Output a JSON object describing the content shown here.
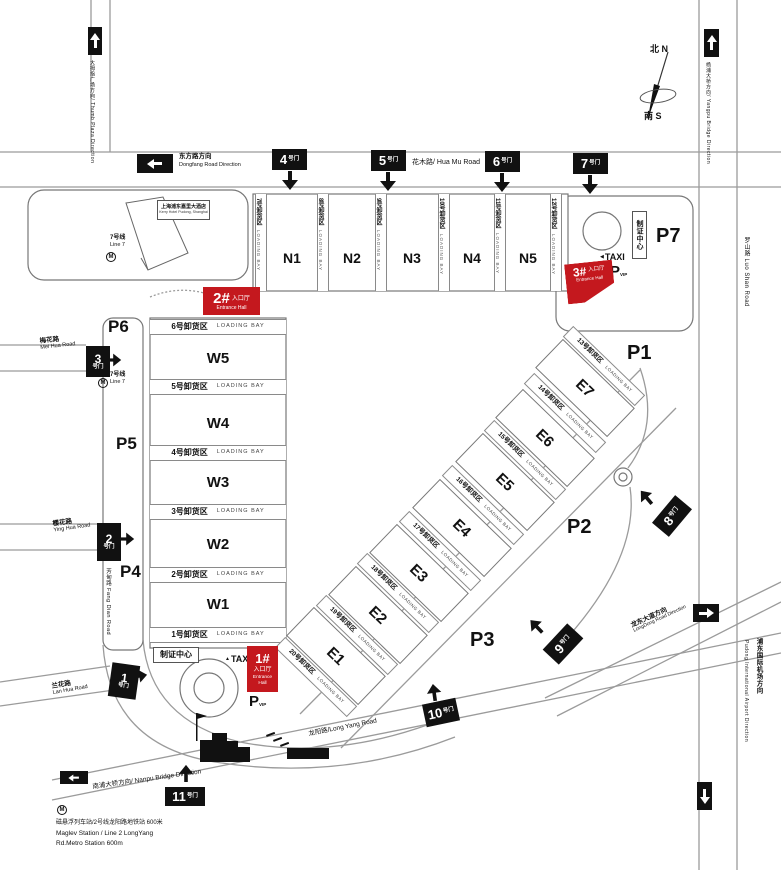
{
  "colors": {
    "accent_red": "#c4181e",
    "gate_black": "#111111",
    "line_gray": "#9b9b9b"
  },
  "compass": {
    "north": "北 N",
    "south": "南 S"
  },
  "directions": {
    "thumb_plaza": "大拇指广场方向/ Thumb Plaza Direction",
    "dongfang_zh": "东方路方向",
    "dongfang_en": "Dongfang Road Direction",
    "yangpu": "杨浦大桥方向/ Yangpu Bridge Direction",
    "longdong_zh": "龙东大道方向",
    "longdong_en": "LongDong Road Direction",
    "airport_zh": "浦东国际机场方向",
    "airport_en": "Pudong International Airport Direction",
    "nanpu": "南浦大桥方向/ Nanpu Bridge Direction"
  },
  "roads": {
    "huamu": "花木路/ Hua Mu Road",
    "meihua_zh": "梅花路",
    "meihua_en": "Mei Hua Road",
    "yinghua_zh": "樱花路",
    "yinghua_en": "Ying Hua Road",
    "lanhua_zh": "兰花路",
    "lanhua_en": "Lan Hua Road",
    "fangdian": "芳甸路 Fang Dian Road",
    "luoshan": "罗山路 Luo Shan Road",
    "longyang": "龙阳路/Long Yang Road"
  },
  "gates": [
    "1",
    "2",
    "3",
    "4",
    "5",
    "6",
    "7",
    "8",
    "9",
    "10",
    "11"
  ],
  "gate_suffix": "号门",
  "halls_north": [
    "N1",
    "N2",
    "N3",
    "N4",
    "N5"
  ],
  "halls_west": [
    "W5",
    "W4",
    "W3",
    "W2",
    "W1"
  ],
  "halls_east": [
    "E1",
    "E2",
    "E3",
    "E4",
    "E5",
    "E6",
    "E7"
  ],
  "bays_north": [
    {
      "zh": "7号卸货区",
      "en": "LOADING BAY"
    },
    {
      "zh": "8号卸货区",
      "en": "LOADING BAY"
    },
    {
      "zh": "9号卸货区",
      "en": "LOADING BAY"
    },
    {
      "zh": "10号卸货区",
      "en": "LOADING BAY"
    },
    {
      "zh": "11号卸货区",
      "en": "LOADING BAY"
    },
    {
      "zh": "12号卸货区",
      "en": "LOADING BAY"
    }
  ],
  "bays_west": [
    {
      "zh": "6号卸货区",
      "en": "LOADING BAY"
    },
    {
      "zh": "5号卸货区",
      "en": "LOADING BAY"
    },
    {
      "zh": "4号卸货区",
      "en": "LOADING BAY"
    },
    {
      "zh": "3号卸货区",
      "en": "LOADING BAY"
    },
    {
      "zh": "2号卸货区",
      "en": "LOADING BAY"
    },
    {
      "zh": "1号卸货区",
      "en": "LOADING BAY"
    }
  ],
  "bays_east": [
    {
      "zh": "20号卸货区",
      "en": "LOADING BAY"
    },
    {
      "zh": "19号卸货区",
      "en": "LOADING BAY"
    },
    {
      "zh": "18号卸货区",
      "en": "LOADING BAY"
    },
    {
      "zh": "17号卸货区",
      "en": "LOADING BAY"
    },
    {
      "zh": "16号卸货区",
      "en": "LOADING BAY"
    },
    {
      "zh": "15号卸货区",
      "en": "LOADING BAY"
    },
    {
      "zh": "14号卸货区",
      "en": "LOADING BAY"
    },
    {
      "zh": "13号卸货区",
      "en": "LOADING BAY"
    }
  ],
  "parking": [
    "P1",
    "P2",
    "P3",
    "P4",
    "P5",
    "P6",
    "P7"
  ],
  "entrances": [
    {
      "num": "1#",
      "zh": "入口厅",
      "en": "Entrance Hall"
    },
    {
      "num": "2#",
      "zh": "入口厅",
      "en": "Entrance Hall"
    },
    {
      "num": "3#",
      "zh": "入口厅",
      "en": "Entrance Hall"
    }
  ],
  "taxi": {
    "label": "TAXI",
    "arrow_left": "◀",
    "arrow_up": "▲"
  },
  "vip": {
    "p": "P",
    "sub": "VIP"
  },
  "badge_center": "制证中心",
  "hotel": {
    "zh": "上海浦东嘉里大酒店",
    "en": "Kerry Hotel Pudong, Shanghai"
  },
  "metro": {
    "m": "M",
    "line7_zh": "7号线",
    "line7_en": "Line 7"
  },
  "maglev": {
    "zh": "磁悬浮列车站/2号线龙阳路地铁站 600米",
    "en1": "Maglev Station / Line 2 LongYang",
    "en2": "Rd.Metro Station 600m"
  }
}
